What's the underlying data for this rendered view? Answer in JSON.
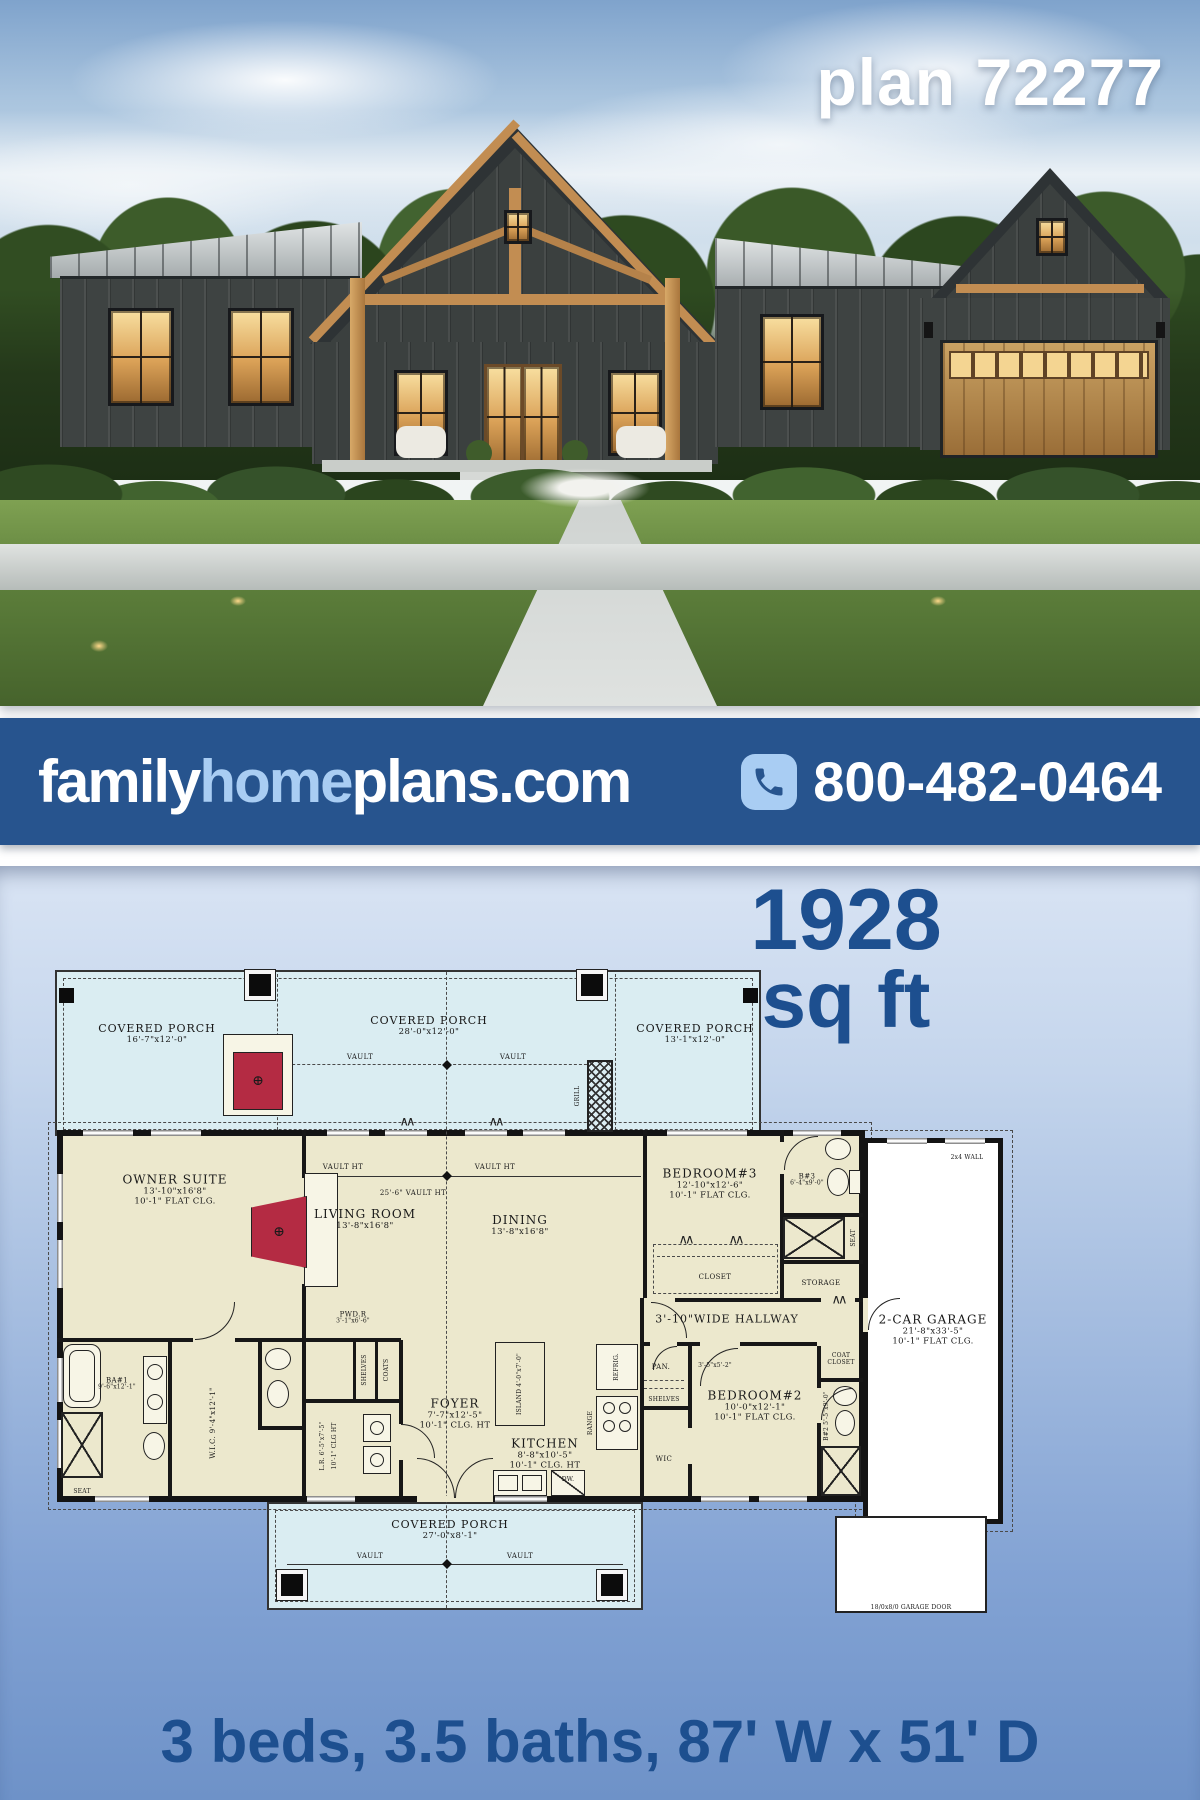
{
  "hero": {
    "plan_label": "plan 72277"
  },
  "banner": {
    "site_part1": "family",
    "site_part2": "home",
    "site_part3": "plans.com",
    "phone": "800-482-0464"
  },
  "stats": {
    "sqft_value": "1928",
    "sqft_unit": "sq ft",
    "tagline": "3 beds, 3.5 baths, 87' W x 51' D"
  },
  "colors": {
    "banner_bg": "#27548e",
    "banner_accent": "#a9cdf3",
    "headline_blue": "#1d4f8f",
    "porch_fill": "#daedf2",
    "room_fill": "#ece8cd",
    "fireplace_red": "#b42b43"
  },
  "fp": {
    "porch": "COVERED PORCH",
    "porch_tl_dims": "16'-7\"x12'-0\"",
    "porch_tm_dims": "28'-0\"x12'-0\"",
    "porch_tr_dims": "13'-1\"x12'-0\"",
    "porch_b_dims": "27'-0\"x8'-1\"",
    "vault": "VAULT",
    "vault_ht": "VAULT HT",
    "vault_span": "25'-6\" VAULT HT",
    "grill": "GRILL",
    "owner_name": "OWNER SUITE",
    "owner_dims": "13'-10\"x16'8\"",
    "owner_clg": "10'-1\" FLAT CLG.",
    "living_name": "LIVING ROOM",
    "living_dims": "13'-8\"x16'8\"",
    "dining_name": "DINING",
    "dining_dims": "13'-8\"x16'8\"",
    "bed3_name": "BEDROOM#3",
    "bed3_dims": "12'-10\"x12'-6\"",
    "bed3_clg": "10'-1\" FLAT CLG.",
    "b3_name": "B#3",
    "b3_dims": "6'-4\"x9'-0\"",
    "seat": "SEAT",
    "storage": "STORAGE",
    "closet": "CLOSET",
    "hallway": "3'-10\"WIDE HALLWAY",
    "garage_name": "2-CAR GARAGE",
    "garage_dims": "21'-8\"x33'-5\"",
    "garage_clg": "10'-1\" FLAT CLG.",
    "garage_door": "18/0x8/0 GARAGE DOOR",
    "wall_note": "2x4 WALL",
    "pwd_name": "PWD.R",
    "pwd_dims": "3'-1\"x6'-6\"",
    "ba1_name": "BA#1",
    "ba1_dims": "9'-6\"x12'-1\"",
    "wic1": "W.I.C. 9'-4\"x12'-1\"",
    "lr": "L.R. 6'-5\"x7'-5\"",
    "lr_clg": "10'-1\" CLG HT",
    "shelves": "SHELVES",
    "coats": "COATS",
    "foyer_name": "FOYER",
    "foyer_dims": "7'-7\"x12'-5\"",
    "foyer_clg": "10'-1\" CLG. HT",
    "kitchen_name": "KITCHEN",
    "kitchen_dims": "8'-8\"x10'-5\"",
    "kitchen_clg": "10'-1\" CLG. HT",
    "island": "ISLAND 4'-0\"x7'-0\"",
    "range": "RANGE",
    "refrig": "REFRIG.",
    "dw": "DW.",
    "pan_name": "PAN.",
    "pan_dims": "3'-5\"x5'-2\"",
    "wic2": "WIC",
    "bed2_name": "BEDROOM#2",
    "bed2_dims": "10'-0\"x12'-1\"",
    "bed2_clg": "10'-1\" FLAT CLG.",
    "coat1": "COAT",
    "b2": "B#2 5'-5\"x9'-0\"",
    "fire_symbol": "⊕",
    "door_fold": "∧∧"
  }
}
